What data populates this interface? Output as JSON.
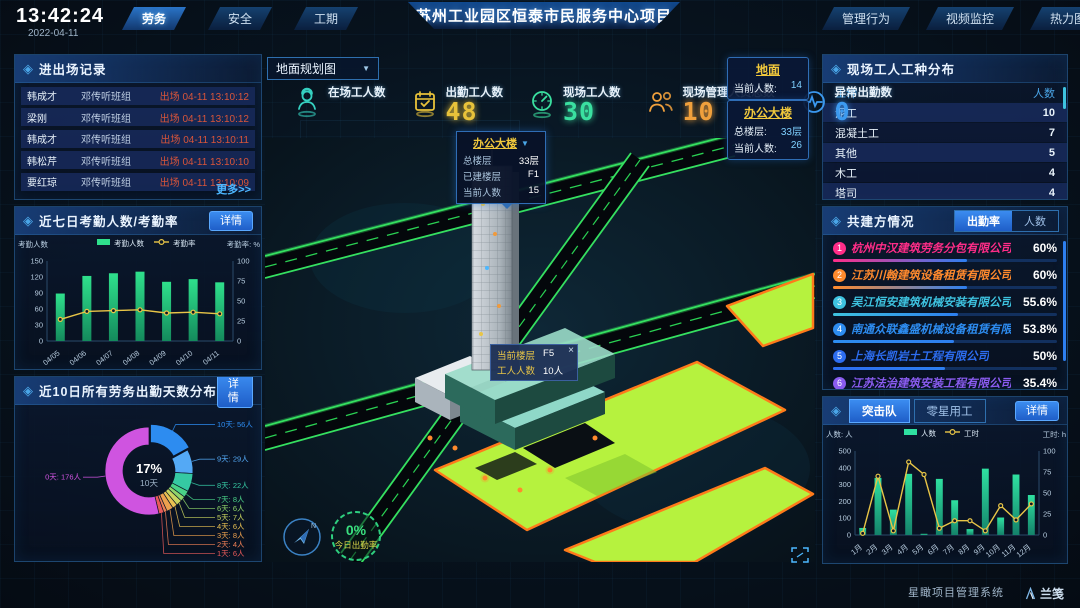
{
  "clock": {
    "time": "13:42:24",
    "date": "2022-04-11"
  },
  "header": {
    "left_tabs": [
      {
        "label": "劳务",
        "active": true
      },
      {
        "label": "安全",
        "active": false
      },
      {
        "label": "工期",
        "active": false
      }
    ],
    "title": "苏州工业园区恒泰市民服务中心项目",
    "right_tabs": [
      {
        "label": "管理行为"
      },
      {
        "label": "视频监控"
      },
      {
        "label": "热力图"
      }
    ]
  },
  "left": {
    "records": {
      "title": "进出场记录",
      "more": "更多>>",
      "rows": [
        {
          "name": "韩成才",
          "group": "邓传听班组",
          "status": "出场 04-11 13:10:12"
        },
        {
          "name": "梁刚",
          "group": "邓传听班组",
          "status": "出场 04-11 13:10:12"
        },
        {
          "name": "韩成才",
          "group": "邓传听班组",
          "status": "出场 04-11 13:10:11"
        },
        {
          "name": "韩松芹",
          "group": "邓传听班组",
          "status": "出场 04-11 13:10:10"
        },
        {
          "name": "要红琼",
          "group": "邓传听班组",
          "status": "出场 04-11 13:10:09"
        }
      ]
    },
    "attendance": {
      "title": "近七日考勤人数/考勤率",
      "detail": "详情",
      "chart": {
        "type": "bar-line",
        "legend": [
          "考勤人数",
          "考勤率"
        ],
        "left_label": "考勤人数",
        "right_label": "考勤率: %",
        "categories": [
          "04/05",
          "04/06",
          "04/07",
          "04/08",
          "04/09",
          "04/10",
          "04/11"
        ],
        "bars": [
          89,
          122,
          127,
          130,
          111,
          116,
          110
        ],
        "line": [
          27,
          37,
          38,
          39,
          35,
          36,
          34
        ],
        "left_ticks": [
          0,
          30,
          60,
          90,
          120,
          150
        ],
        "right_ticks": [
          0,
          25,
          50,
          75,
          100
        ],
        "bar_color": "#2fe08c",
        "bar_color_dark": "#148a5c",
        "line_color": "#e8c547"
      }
    },
    "donut_panel": {
      "title": "近10日所有劳务出勤天数分布",
      "detail": "详情",
      "chart": {
        "type": "doughnut",
        "center_pct": "17%",
        "center_label": "10天",
        "segments": [
          {
            "label": "10天",
            "count": "56人",
            "value": 56,
            "color": "#2d8cf0",
            "highlight": true
          },
          {
            "label": "9天",
            "count": "29人",
            "value": 29,
            "color": "#54a9f5"
          },
          {
            "label": "8天",
            "count": "22人",
            "value": 22,
            "color": "#35c9a3"
          },
          {
            "label": "7天",
            "count": "8人",
            "value": 8,
            "color": "#49d187"
          },
          {
            "label": "6天",
            "count": "6人",
            "value": 6,
            "color": "#8fd46a"
          },
          {
            "label": "5天",
            "count": "7人",
            "value": 7,
            "color": "#c9d45e"
          },
          {
            "label": "4天",
            "count": "6人",
            "value": 6,
            "color": "#e8c052"
          },
          {
            "label": "3天",
            "count": "8人",
            "value": 8,
            "color": "#eda04e"
          },
          {
            "label": "2天",
            "count": "4人",
            "value": 4,
            "color": "#ef7f55"
          },
          {
            "label": "1天",
            "count": "6人",
            "value": 6,
            "color": "#e85a5a"
          },
          {
            "label": "0天",
            "count": "176人",
            "value": 176,
            "color": "#cf54e0"
          }
        ]
      }
    }
  },
  "center": {
    "map_select": {
      "value": "地面规划图"
    },
    "stats": [
      {
        "label": "在场工人数",
        "value": "",
        "icon": "worker-icon",
        "color": "#35d0c0"
      },
      {
        "label": "出勤工人数",
        "value": "48",
        "icon": "calendar-check-icon",
        "color": "#e8c23a"
      },
      {
        "label": "现场工人数",
        "value": "30",
        "icon": "gauge-icon",
        "color": "#3ae0a0"
      },
      {
        "label": "现场管理人员总数",
        "value": "10",
        "icon": "people-icon",
        "color": "#f0a03c"
      },
      {
        "label": "异常出勤数",
        "value": "0",
        "icon": "pulse-icon",
        "color": "#3c9af0"
      }
    ],
    "building_popup": {
      "title": "办公大楼",
      "rows": [
        {
          "label": "总楼层",
          "value": "33层"
        },
        {
          "label": "已建楼层",
          "value": "F1"
        },
        {
          "label": "当前人数",
          "value": "15"
        }
      ]
    },
    "floor_tooltip": {
      "close": "×",
      "rows": [
        {
          "label": "当前楼层",
          "value": "F5"
        },
        {
          "label": "工人人数",
          "value": "10人"
        }
      ]
    },
    "badges": [
      {
        "title": "地面",
        "rows": [
          {
            "label": "当前人数:",
            "value": "14"
          }
        ]
      },
      {
        "title": "办公大楼",
        "rows": [
          {
            "label": "总楼层:",
            "value": "33层"
          },
          {
            "label": "当前人数:",
            "value": "26"
          }
        ]
      }
    ],
    "gauge": {
      "value": "0%",
      "label": "今日出勤率"
    }
  },
  "right": {
    "types": {
      "title": "现场工人工种分布",
      "columns": [
        "工种",
        "人数"
      ],
      "rows": [
        {
          "type": "泥工",
          "count": "10"
        },
        {
          "type": "混凝土工",
          "count": "7"
        },
        {
          "type": "其他",
          "count": "5"
        },
        {
          "type": "木工",
          "count": "4"
        },
        {
          "type": "塔司",
          "count": "4"
        }
      ]
    },
    "partners": {
      "title": "共建方情况",
      "tabs": [
        {
          "label": "出勤率",
          "active": true
        },
        {
          "label": "人数",
          "active": false
        }
      ],
      "companies": [
        {
          "rank": "1",
          "name": "杭州中汉建筑劳务分包有限公司",
          "value": "60%",
          "pct": 60,
          "color": "#ff2d88"
        },
        {
          "rank": "2",
          "name": "江苏川翰建筑设备租赁有限公司",
          "value": "60%",
          "pct": 60,
          "color": "#ff8a2d"
        },
        {
          "rank": "3",
          "name": "吴江恒安建筑机械安装有限公司",
          "value": "55.6%",
          "pct": 55.6,
          "color": "#3ec3e0"
        },
        {
          "rank": "4",
          "name": "南通众联鑫盛机械设备租赁有限公司",
          "value": "53.8%",
          "pct": 53.8,
          "color": "#2d8cf0"
        },
        {
          "rank": "5",
          "name": "上海长凯岩土工程有限公司",
          "value": "50%",
          "pct": 50,
          "color": "#2d6df0"
        },
        {
          "rank": "6",
          "name": "江苏法治建筑安装工程有限公司",
          "value": "35.4%",
          "pct": 35.4,
          "color": "#8a5cf0"
        }
      ]
    },
    "team": {
      "tabs": [
        {
          "label": "突击队",
          "active": true
        },
        {
          "label": "零星用工",
          "active": false
        }
      ],
      "detail": "详情",
      "chart": {
        "type": "bar-line",
        "legend": [
          "人数",
          "工时"
        ],
        "left_label": "人数: 人",
        "right_label": "工时: h",
        "categories": [
          "1月",
          "2月",
          "3月",
          "4月",
          "5月",
          "6月",
          "7月",
          "8月",
          "9月",
          "10月",
          "11月",
          "12月"
        ],
        "bars": [
          42,
          340,
          151,
          364,
          7,
          334,
          207,
          35,
          395,
          104,
          360,
          238
        ],
        "line": [
          2,
          70,
          5,
          87,
          72,
          8,
          17,
          17,
          5,
          35,
          18,
          37
        ],
        "left_ticks": [
          0,
          100,
          200,
          300,
          400,
          500
        ],
        "right_ticks": [
          0,
          25,
          50,
          75,
          100
        ],
        "bar_color": "#2fe0a0",
        "bar_color_dark": "#14826a",
        "line_color": "#e8c547"
      }
    }
  },
  "footer": {
    "system": "星瞰项目管理系统",
    "logo": "兰笺"
  }
}
